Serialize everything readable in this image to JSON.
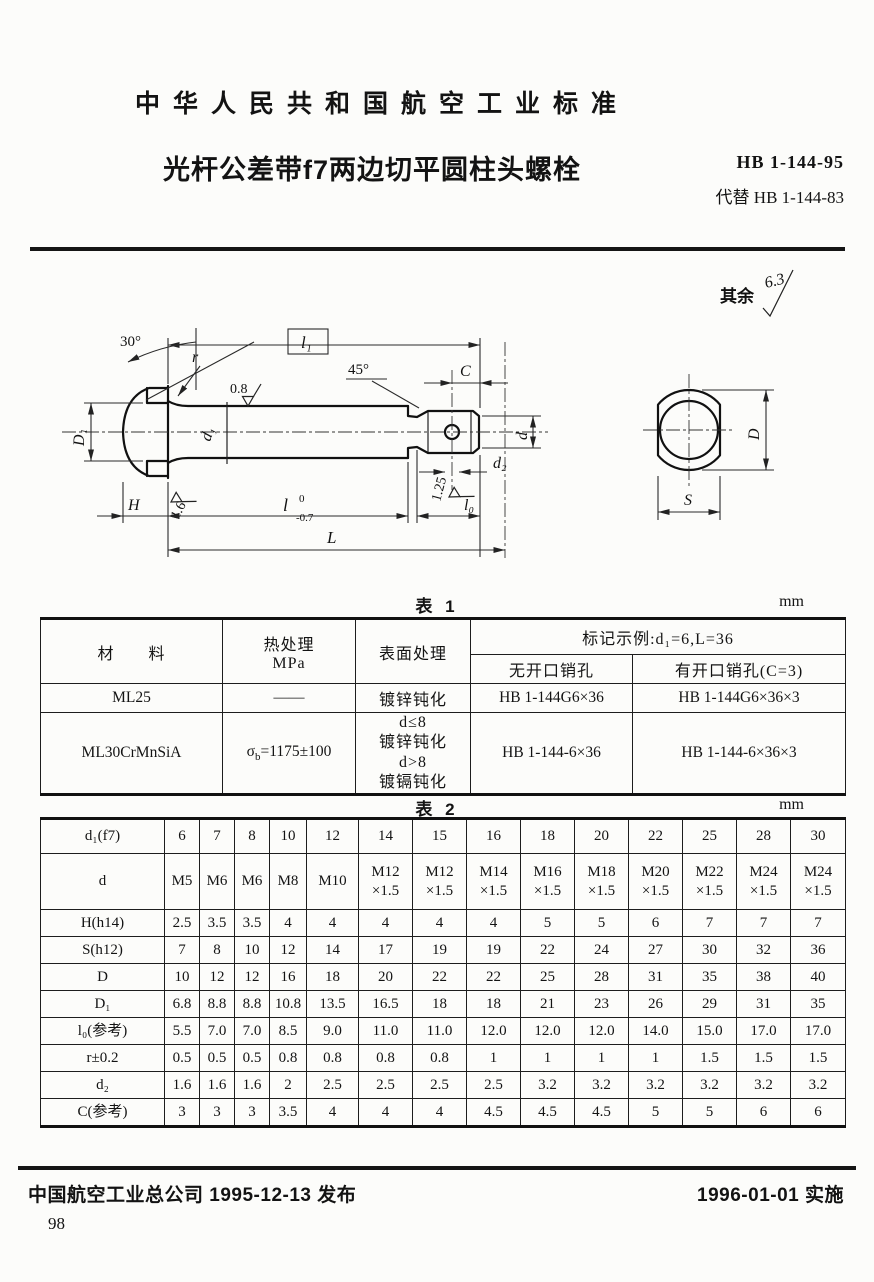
{
  "header": {
    "standard_org": "中华人民共和国航空工业标准",
    "title": "光杆公差带f7两边切平圆柱头螺栓",
    "standard_no": "HB 1-144-95",
    "replaces": "代替 HB 1-144-83"
  },
  "drawing": {
    "remainder": {
      "label": "其余",
      "value": "6.3"
    },
    "dims": {
      "angle_head": "30°",
      "radius": "r",
      "l1": "l₁",
      "rough_shank": "0.8",
      "angle_chamfer": "45°",
      "c": "C",
      "D1": "D₁",
      "d1": "d₁",
      "d": "d",
      "d2": "d₂",
      "H": "H",
      "rough_face": "1.6",
      "l": "l",
      "l_tol_upper": "0",
      "l_tol_lower": "-0.7",
      "rough_thread": "1.25",
      "l0": "l₀",
      "L": "L",
      "D": "D",
      "S": "S"
    }
  },
  "table1": {
    "caption": "表 1",
    "unit": "mm",
    "header": {
      "material": "材　　料",
      "heat_line1": "热处理",
      "heat_line2": "MPa",
      "surface": "表面处理",
      "example": "标记示例:d₁=6,L=36",
      "no_pin_hole": "无开口销孔",
      "with_pin_hole": "有开口销孔(C=3)"
    },
    "rows": [
      {
        "material": "ML25",
        "heat": "——",
        "surface": "镀锌钝化",
        "no_hole": "HB 1-144G6×36",
        "with_hole": "HB 1-144G6×36×3"
      },
      {
        "material": "ML30CrMnSiA",
        "heat_sym": "σ",
        "heat_sub": "b",
        "heat_val": "=1175±100",
        "surface": "d≤8\n镀锌钝化\nd>8\n镀镉钝化",
        "no_hole": "HB 1-144-6×36",
        "with_hole": "HB 1-144-6×36×3"
      }
    ]
  },
  "table2": {
    "caption": "表 2",
    "unit": "mm",
    "rows": [
      {
        "label": "d₁(f7)",
        "values": [
          "6",
          "7",
          "8",
          "10",
          "12",
          "14",
          "15",
          "16",
          "18",
          "20",
          "22",
          "25",
          "28",
          "30"
        ]
      },
      {
        "label": "d",
        "values": [
          "M5",
          "M6",
          "M6",
          "M8",
          "M10",
          "M12 ×1.5",
          "M12 ×1.5",
          "M14 ×1.5",
          "M16 ×1.5",
          "M18 ×1.5",
          "M20 ×1.5",
          "M22 ×1.5",
          "M24 ×1.5",
          "M24 ×1.5"
        ]
      },
      {
        "label": "H(h14)",
        "values": [
          "2.5",
          "3.5",
          "3.5",
          "4",
          "4",
          "4",
          "4",
          "4",
          "5",
          "5",
          "6",
          "7",
          "7",
          "7"
        ]
      },
      {
        "label": "S(h12)",
        "values": [
          "7",
          "8",
          "10",
          "12",
          "14",
          "17",
          "19",
          "19",
          "22",
          "24",
          "27",
          "30",
          "32",
          "36"
        ]
      },
      {
        "label": "D",
        "values": [
          "10",
          "12",
          "12",
          "16",
          "18",
          "20",
          "22",
          "22",
          "25",
          "28",
          "31",
          "35",
          "38",
          "40"
        ]
      },
      {
        "label": "D₁",
        "values": [
          "6.8",
          "8.8",
          "8.8",
          "10.8",
          "13.5",
          "16.5",
          "18",
          "18",
          "21",
          "23",
          "26",
          "29",
          "31",
          "35"
        ]
      },
      {
        "label": "l₀(参考)",
        "values": [
          "5.5",
          "7.0",
          "7.0",
          "8.5",
          "9.0",
          "11.0",
          "11.0",
          "12.0",
          "12.0",
          "12.0",
          "14.0",
          "15.0",
          "17.0",
          "17.0"
        ]
      },
      {
        "label": "r±0.2",
        "values": [
          "0.5",
          "0.5",
          "0.5",
          "0.8",
          "0.8",
          "0.8",
          "0.8",
          "1",
          "1",
          "1",
          "1",
          "1.5",
          "1.5",
          "1.5"
        ]
      },
      {
        "label": "d₂",
        "values": [
          "1.6",
          "1.6",
          "1.6",
          "2",
          "2.5",
          "2.5",
          "2.5",
          "2.5",
          "3.2",
          "3.2",
          "3.2",
          "3.2",
          "3.2",
          "3.2"
        ]
      },
      {
        "label": "C(参考)",
        "values": [
          "3",
          "3",
          "3",
          "3.5",
          "4",
          "4",
          "4",
          "4.5",
          "4.5",
          "4.5",
          "5",
          "5",
          "6",
          "6"
        ]
      }
    ]
  },
  "footer": {
    "issued": "中国航空工业总公司 1995-12-13 发布",
    "effective": "1996-01-01 实施",
    "page_number": "98"
  }
}
